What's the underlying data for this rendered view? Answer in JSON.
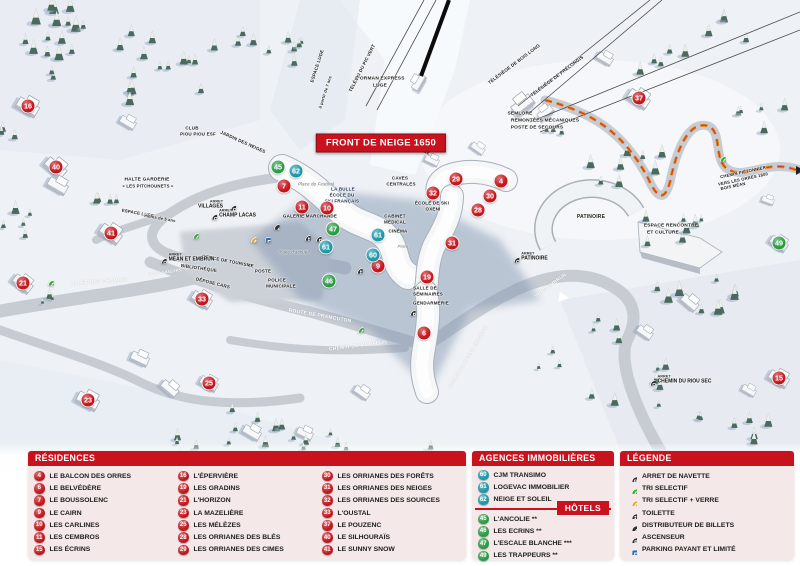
{
  "map": {
    "banner": "FRONT DE NEIGE 1650",
    "arret_label": "ARRET",
    "marker_colors": {
      "residence": "#c4161d",
      "hotel": "#2a9b44",
      "agency": "#1e98a9"
    },
    "markers": {
      "residences": [
        {
          "n": 4,
          "x": 501,
          "y": 181
        },
        {
          "n": 6,
          "x": 424,
          "y": 333
        },
        {
          "n": 7,
          "x": 284,
          "y": 186
        },
        {
          "n": 9,
          "x": 378,
          "y": 266
        },
        {
          "n": 10,
          "x": 327,
          "y": 208
        },
        {
          "n": 11,
          "x": 302,
          "y": 207
        },
        {
          "n": 15,
          "x": 779,
          "y": 378
        },
        {
          "n": 16,
          "x": 28,
          "y": 106
        },
        {
          "n": 19,
          "x": 427,
          "y": 277
        },
        {
          "n": 21,
          "x": 23,
          "y": 283
        },
        {
          "n": 23,
          "x": 88,
          "y": 400
        },
        {
          "n": 25,
          "x": 209,
          "y": 383
        },
        {
          "n": 28,
          "x": 478,
          "y": 210
        },
        {
          "n": 29,
          "x": 456,
          "y": 179
        },
        {
          "n": 30,
          "x": 490,
          "y": 196
        },
        {
          "n": 31,
          "x": 452,
          "y": 243
        },
        {
          "n": 32,
          "x": 433,
          "y": 193
        },
        {
          "n": 33,
          "x": 202,
          "y": 299
        },
        {
          "n": 37,
          "x": 639,
          "y": 98
        },
        {
          "n": 40,
          "x": 56,
          "y": 167
        },
        {
          "n": 41,
          "x": 111,
          "y": 233
        }
      ],
      "hotels": [
        {
          "n": 45,
          "x": 278,
          "y": 167
        },
        {
          "n": 46,
          "x": 329,
          "y": 281
        },
        {
          "n": 47,
          "x": 333,
          "y": 229
        },
        {
          "n": 49,
          "x": 779,
          "y": 243
        }
      ],
      "agencies": [
        {
          "n": 60,
          "x": 373,
          "y": 255
        },
        {
          "n": 61,
          "x": 378,
          "y": 235
        },
        {
          "n": 61,
          "x": 326,
          "y": 247
        },
        {
          "n": 62,
          "x": 296,
          "y": 171
        }
      ]
    },
    "bus_stops": [
      {
        "id": "villages",
        "label": "VILLAGES",
        "x": 217,
        "y": 205,
        "side": "left"
      },
      {
        "id": "champ-lacas",
        "label": "CHAMP LACAS",
        "x": 231,
        "y": 214,
        "side": "right"
      },
      {
        "id": "mean-et-embrun",
        "label": "MEAN ET EMBRUN",
        "x": 185,
        "y": 258,
        "side": "right"
      },
      {
        "id": "patinoire",
        "label": "PATINOIRE",
        "x": 528,
        "y": 257,
        "side": "right"
      },
      {
        "id": "chemin-du-riou-sec",
        "label": "CHEMIN DU RIOU SEC",
        "x": 678,
        "y": 380,
        "side": "right"
      }
    ],
    "icons": [
      {
        "k": "recycle-green",
        "x": 193,
        "y": 233
      },
      {
        "k": "recycle-green",
        "x": 48,
        "y": 280
      },
      {
        "k": "recycle-green",
        "x": 358,
        "y": 327
      },
      {
        "k": "recycle-green",
        "x": 720,
        "y": 156
      },
      {
        "k": "recycle-yellow",
        "x": 251,
        "y": 237
      },
      {
        "k": "parking",
        "x": 265,
        "y": 237
      },
      {
        "k": "euro",
        "x": 274,
        "y": 224
      },
      {
        "k": "wc",
        "x": 305,
        "y": 235
      },
      {
        "k": "elevator",
        "x": 316,
        "y": 236
      },
      {
        "k": "wc",
        "x": 357,
        "y": 268
      },
      {
        "k": "elevator",
        "x": 410,
        "y": 310
      }
    ],
    "labels": [
      {
        "t": "ESPACE LUGE",
        "x": 317,
        "y": 66,
        "r": -72,
        "s": 4.5
      },
      {
        "t": "à partir de 7 ans",
        "x": 325,
        "y": 92,
        "r": -72,
        "s": 4
      },
      {
        "t": "TÉLÉSKI DU PIC VERT",
        "x": 362,
        "y": 68,
        "r": -63,
        "s": 4.5
      },
      {
        "t": "L'ORMAN EXPRESS",
        "x": 380,
        "y": 79,
        "s": 4.8
      },
      {
        "t": "LUGE",
        "x": 380,
        "y": 86,
        "s": 4.8
      },
      {
        "t": "TÉLÉSIÈGE DE BOIS LONG",
        "x": 514,
        "y": 64,
        "r": -37,
        "s": 4.5
      },
      {
        "t": "TÉLÉSIÈGE DE PRÉLONGIS",
        "x": 557,
        "y": 76,
        "r": -37,
        "s": 4.5
      },
      {
        "t": "SEMLORE",
        "x": 520,
        "y": 114,
        "s": 4.8
      },
      {
        "t": "REMONTÉES MÉCANIQUES",
        "x": 545,
        "y": 121,
        "s": 4.8
      },
      {
        "t": "POSTE DE SECOURS",
        "x": 537,
        "y": 128,
        "s": 4.8
      },
      {
        "t": "CLUB",
        "x": 192,
        "y": 128,
        "s": 4.5
      },
      {
        "t": "PIOU PIOU ESF",
        "x": 198,
        "y": 134,
        "s": 4.5
      },
      {
        "t": "JARDIN DES NEIGES",
        "x": 243,
        "y": 142,
        "r": 24,
        "s": 4.5
      },
      {
        "t": "HALTE GARDERIE",
        "x": 147,
        "y": 180,
        "s": 4.8
      },
      {
        "t": "« LES PITCHOUNETS »",
        "x": 148,
        "y": 186,
        "s": 4.3
      },
      {
        "t": "ESPACE LUGE",
        "x": 138,
        "y": 213,
        "r": 10,
        "s": 4.3
      },
      {
        "t": "moins de 5 ans",
        "x": 160,
        "y": 218,
        "r": 10,
        "s": 4
      },
      {
        "t": "ALLÉE DES CHAMOIS",
        "x": 99,
        "y": 282,
        "r": -4,
        "v": "road",
        "s": 5
      },
      {
        "t": "PONT SKIEURS",
        "x": 165,
        "y": 272,
        "r": -8,
        "v": "road",
        "s": 4.2
      },
      {
        "t": "ROUTE DE PRAMOUTON",
        "x": 320,
        "y": 316,
        "r": 10,
        "v": "road",
        "s": 5
      },
      {
        "t": "CHEMIN DU MOUFLON",
        "x": 358,
        "y": 346,
        "r": -7,
        "v": "road",
        "s": 5
      },
      {
        "t": "CHEMIN DU GRAND CORREAU",
        "x": 468,
        "y": 357,
        "r": -59,
        "v": "road",
        "s": 4.5
      },
      {
        "t": "VERS EMBRUN",
        "x": 551,
        "y": 286,
        "r": -36,
        "v": "road",
        "s": 4.8
      },
      {
        "t": "Place du Festival",
        "x": 316,
        "y": 184,
        "v": "place",
        "s": 4.3
      },
      {
        "t": "LA BULLE",
        "x": 343,
        "y": 189,
        "v": "navy",
        "s": 4.5
      },
      {
        "t": "ÉCOLE DU",
        "x": 342,
        "y": 195,
        "v": "navy",
        "s": 4.5
      },
      {
        "t": "SKI FRANÇAIS",
        "x": 342,
        "y": 201,
        "v": "navy",
        "s": 4.5
      },
      {
        "t": "GALERIE MARCHANDE",
        "x": 310,
        "y": 216,
        "s": 4.5
      },
      {
        "t": "OFFICE DE TOURISME",
        "x": 228,
        "y": 261,
        "r": 11,
        "s": 4.5
      },
      {
        "t": "BIBLIOTHÈQUE",
        "x": 199,
        "y": 268,
        "r": 8,
        "s": 4.5
      },
      {
        "t": "POSTE",
        "x": 263,
        "y": 271,
        "s": 4.5
      },
      {
        "t": "DÉPOSE CARS",
        "x": 213,
        "y": 283,
        "r": 14,
        "s": 4.5
      },
      {
        "t": "POLICE",
        "x": 277,
        "y": 280,
        "s": 4.5
      },
      {
        "t": "MUNICIPALE",
        "x": 281,
        "y": 286,
        "s": 4.5
      },
      {
        "t": "Place d'accueil",
        "x": 294,
        "y": 252,
        "v": "place",
        "s": 4.3
      },
      {
        "t": "CAVES",
        "x": 400,
        "y": 178,
        "s": 4.5
      },
      {
        "t": "CENTRALES",
        "x": 401,
        "y": 184,
        "s": 4.5
      },
      {
        "t": "CABINET",
        "x": 395,
        "y": 216,
        "s": 4.5
      },
      {
        "t": "MÉDICAL",
        "x": 395,
        "y": 222,
        "s": 4.5
      },
      {
        "t": "CINÉMA",
        "x": 398,
        "y": 231,
        "s": 4.5
      },
      {
        "t": "Place",
        "x": 403,
        "y": 246,
        "v": "place",
        "s": 4
      },
      {
        "t": "LAVERIE",
        "x": 420,
        "y": 150,
        "r": 18,
        "s": 4.5
      },
      {
        "t": "ÉCOLE DE SKI",
        "x": 432,
        "y": 203,
        "s": 4.5
      },
      {
        "t": "OXENI",
        "x": 433,
        "y": 209,
        "s": 4.5
      },
      {
        "t": "SALLE DE",
        "x": 425,
        "y": 288,
        "s": 4.5
      },
      {
        "t": "SÉMINAIRES",
        "x": 428,
        "y": 294,
        "s": 4.5
      },
      {
        "t": "GENDARMERIE",
        "x": 431,
        "y": 303,
        "s": 4.5
      },
      {
        "t": "PATINOIRE",
        "x": 591,
        "y": 217,
        "s": 5
      },
      {
        "t": "ESPACE RENCONTRE",
        "x": 671,
        "y": 226,
        "s": 4.8
      },
      {
        "t": "ET CULTURE",
        "x": 663,
        "y": 233,
        "s": 4.8
      },
      {
        "t": "CHEMIN PIÉTONNIER",
        "x": 743,
        "y": 172,
        "r": -12,
        "s": 4.2
      },
      {
        "t": "VERS LES ORRES 1800",
        "x": 743,
        "y": 179,
        "r": -12,
        "s": 4.2
      },
      {
        "t": "BOIS MÉAN",
        "x": 733,
        "y": 186,
        "r": -12,
        "s": 4.2
      }
    ]
  },
  "legend": {
    "residences": {
      "title": "RÉSIDENCES",
      "items": [
        {
          "n": 4,
          "name": "LE BALCON DES ORRES"
        },
        {
          "n": 6,
          "name": "LE BELVÉDÈRE"
        },
        {
          "n": 7,
          "name": "LE BOUSSOLENC"
        },
        {
          "n": 9,
          "name": "LE CAIRN"
        },
        {
          "n": 10,
          "name": "LES CARLINES"
        },
        {
          "n": 11,
          "name": "LES CEMBROS"
        },
        {
          "n": 15,
          "name": "LES ÉCRINS"
        },
        {
          "n": 16,
          "name": "L'ÉPERVIÈRE"
        },
        {
          "n": 19,
          "name": "LES GRADINS"
        },
        {
          "n": 21,
          "name": "L'HORIZON"
        },
        {
          "n": 23,
          "name": "LA MAZELIÈRE"
        },
        {
          "n": 25,
          "name": "LES MÉLÈZES"
        },
        {
          "n": 28,
          "name": "LES ORRIANES DES BLÉS"
        },
        {
          "n": 29,
          "name": "LES ORRIANES DES CIMES"
        },
        {
          "n": 30,
          "name": "LES ORRIANES DES FORÊTS"
        },
        {
          "n": 31,
          "name": "LES ORRIANES DES NEIGES"
        },
        {
          "n": 32,
          "name": "LES ORRIANES DES SOURCES"
        },
        {
          "n": 33,
          "name": "L'OUSTAL"
        },
        {
          "n": 37,
          "name": "LE POUZENC"
        },
        {
          "n": 40,
          "name": "LE SILHOURAÏS"
        },
        {
          "n": 41,
          "name": "LE SUNNY SNOW"
        }
      ]
    },
    "agences": {
      "title": "AGENCES IMMOBILIÈRES",
      "items": [
        {
          "n": 60,
          "name": "CJM TRANSIMO"
        },
        {
          "n": 61,
          "name": "LOGEVAC IMMOBILIER"
        },
        {
          "n": 62,
          "name": "NEIGE ET SOLEIL"
        }
      ]
    },
    "hotels": {
      "title": "HÔTELS",
      "items": [
        {
          "n": 45,
          "name": "L'ANCOLIE **"
        },
        {
          "n": 46,
          "name": "LES ECRINS **"
        },
        {
          "n": 47,
          "name": "L'ESCALE BLANCHE ***"
        },
        {
          "n": 49,
          "name": "LES TRAPPEURS **"
        }
      ]
    },
    "legende": {
      "title": "LÉGENDE",
      "items": [
        {
          "icon": "bus",
          "label": "ARRET DE NAVETTE"
        },
        {
          "icon": "recycle-green",
          "label": "TRI SELECTIF"
        },
        {
          "icon": "recycle-yellow",
          "label": "TRI SELECTIF + VERRE"
        },
        {
          "icon": "wc",
          "label": "TOILETTE"
        },
        {
          "icon": "euro",
          "label": "DISTRIBUTEUR DE BILLETS"
        },
        {
          "icon": "elevator",
          "label": "ASCENSEUR"
        },
        {
          "icon": "parking",
          "label": "PARKING PAYANT ET LIMITÉ"
        }
      ]
    }
  }
}
